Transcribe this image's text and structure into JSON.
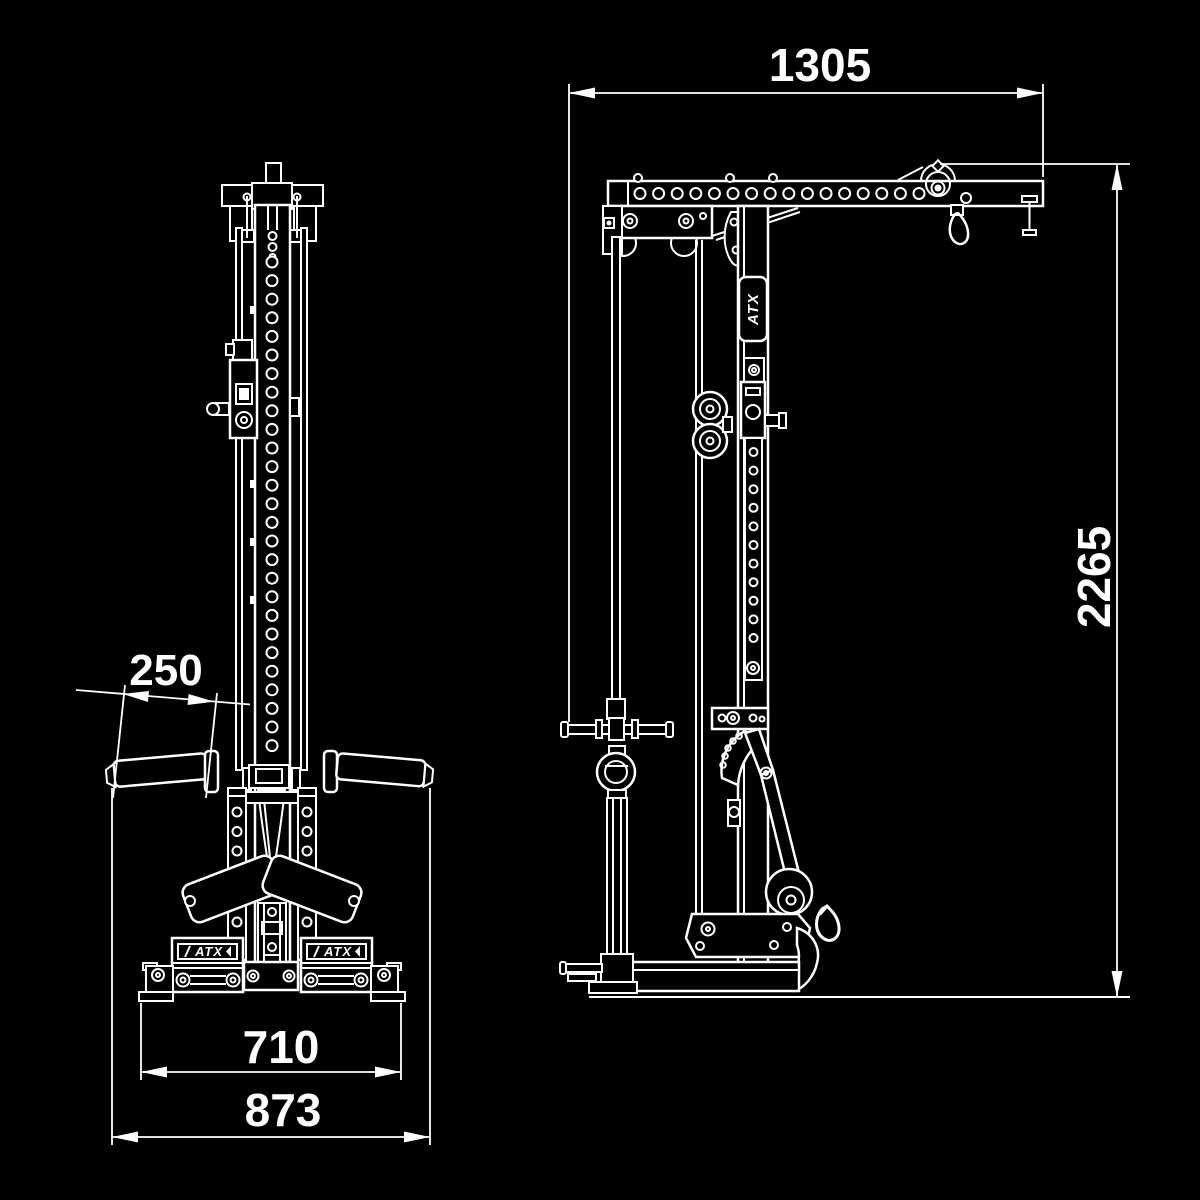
{
  "colors": {
    "background": "#000000",
    "line": "#ffffff"
  },
  "brand": {
    "logo_text": "ATX"
  },
  "dimensions": {
    "top_depth": "1305",
    "total_height": "2265",
    "handle_length": "250",
    "base_inner_width": "710",
    "base_outer_width": "873"
  },
  "logos": {
    "left_platform": "ATX",
    "right_platform": "ATX",
    "column_plate": "ATX"
  }
}
